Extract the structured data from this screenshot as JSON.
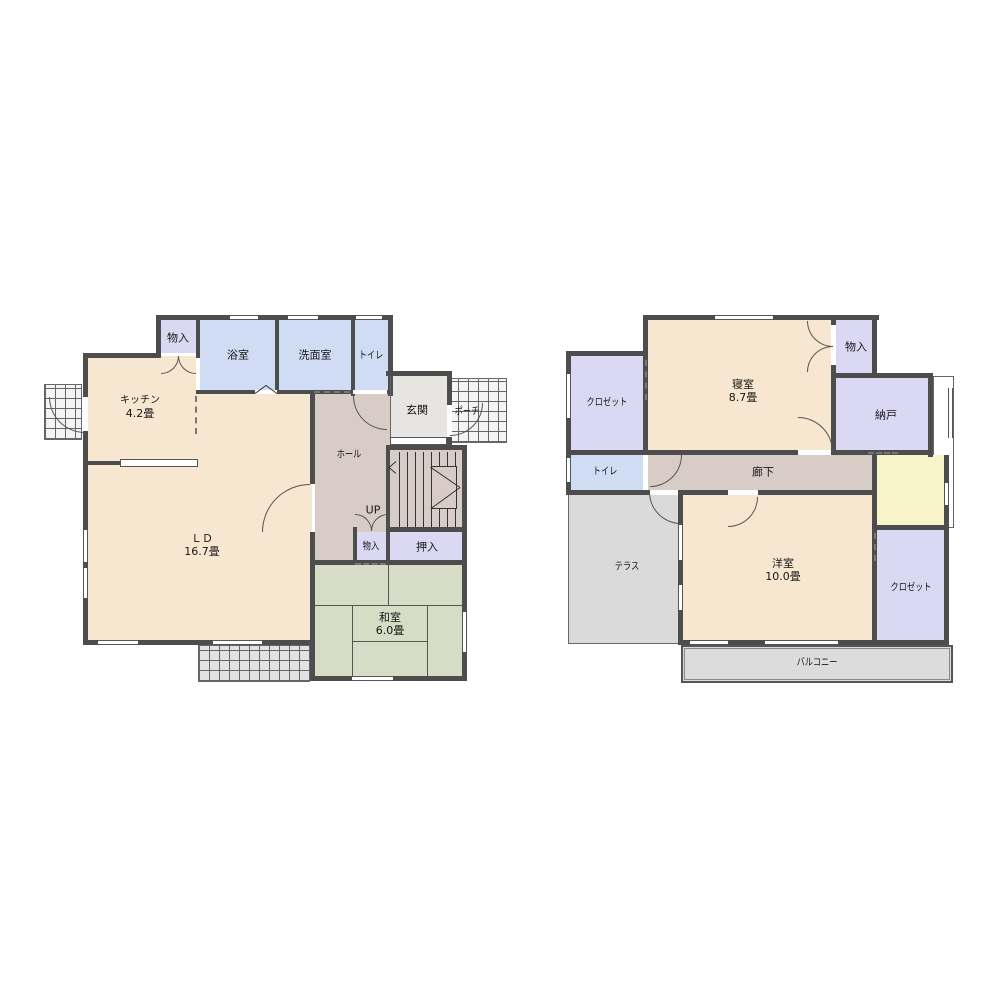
{
  "floors": {
    "f1": {
      "storage_top": {
        "name": "物入"
      },
      "bath": {
        "name": "浴室"
      },
      "wash": {
        "name": "洗面室"
      },
      "toilet": {
        "name": "トイレ"
      },
      "kitchen": {
        "name": "キッチン",
        "size": "4.2畳"
      },
      "entry": {
        "name": "玄関"
      },
      "porch": {
        "name": "ポーチ"
      },
      "hall": {
        "name": "ホール"
      },
      "ld": {
        "name": "ＬＤ",
        "size": "16.7畳"
      },
      "up": {
        "name": "UP"
      },
      "storage_hall": {
        "name": "物入"
      },
      "oshiire": {
        "name": "押入"
      },
      "washitsu": {
        "name": "和室",
        "size": "6.0畳"
      }
    },
    "f2": {
      "closet_nw": {
        "name": "クロゼット"
      },
      "bedroom": {
        "name": "寝室",
        "size": "8.7畳"
      },
      "storage": {
        "name": "物入"
      },
      "nando": {
        "name": "納戸"
      },
      "toilet": {
        "name": "トイレ"
      },
      "corridor": {
        "name": "廊下"
      },
      "terrace": {
        "name": "テラス"
      },
      "youshitsu": {
        "name": "洋室",
        "size": "10.0畳"
      },
      "closet_se": {
        "name": "クロゼット"
      },
      "balcony": {
        "name": "バルコニー"
      }
    }
  },
  "colors": {
    "wall": "#4d4d4d",
    "room_cream": "#f8e7d0",
    "room_blue": "#cfdcf3",
    "room_purple": "#dbd8f3",
    "room_green": "#d6dcc6",
    "hall_tan": "#d7ccc6",
    "entry_gray": "#e7e5e2",
    "terrace_gray": "#dadada",
    "balcony_gray": "#dcdcdc",
    "stair_yellow": "#f8f4c9"
  }
}
